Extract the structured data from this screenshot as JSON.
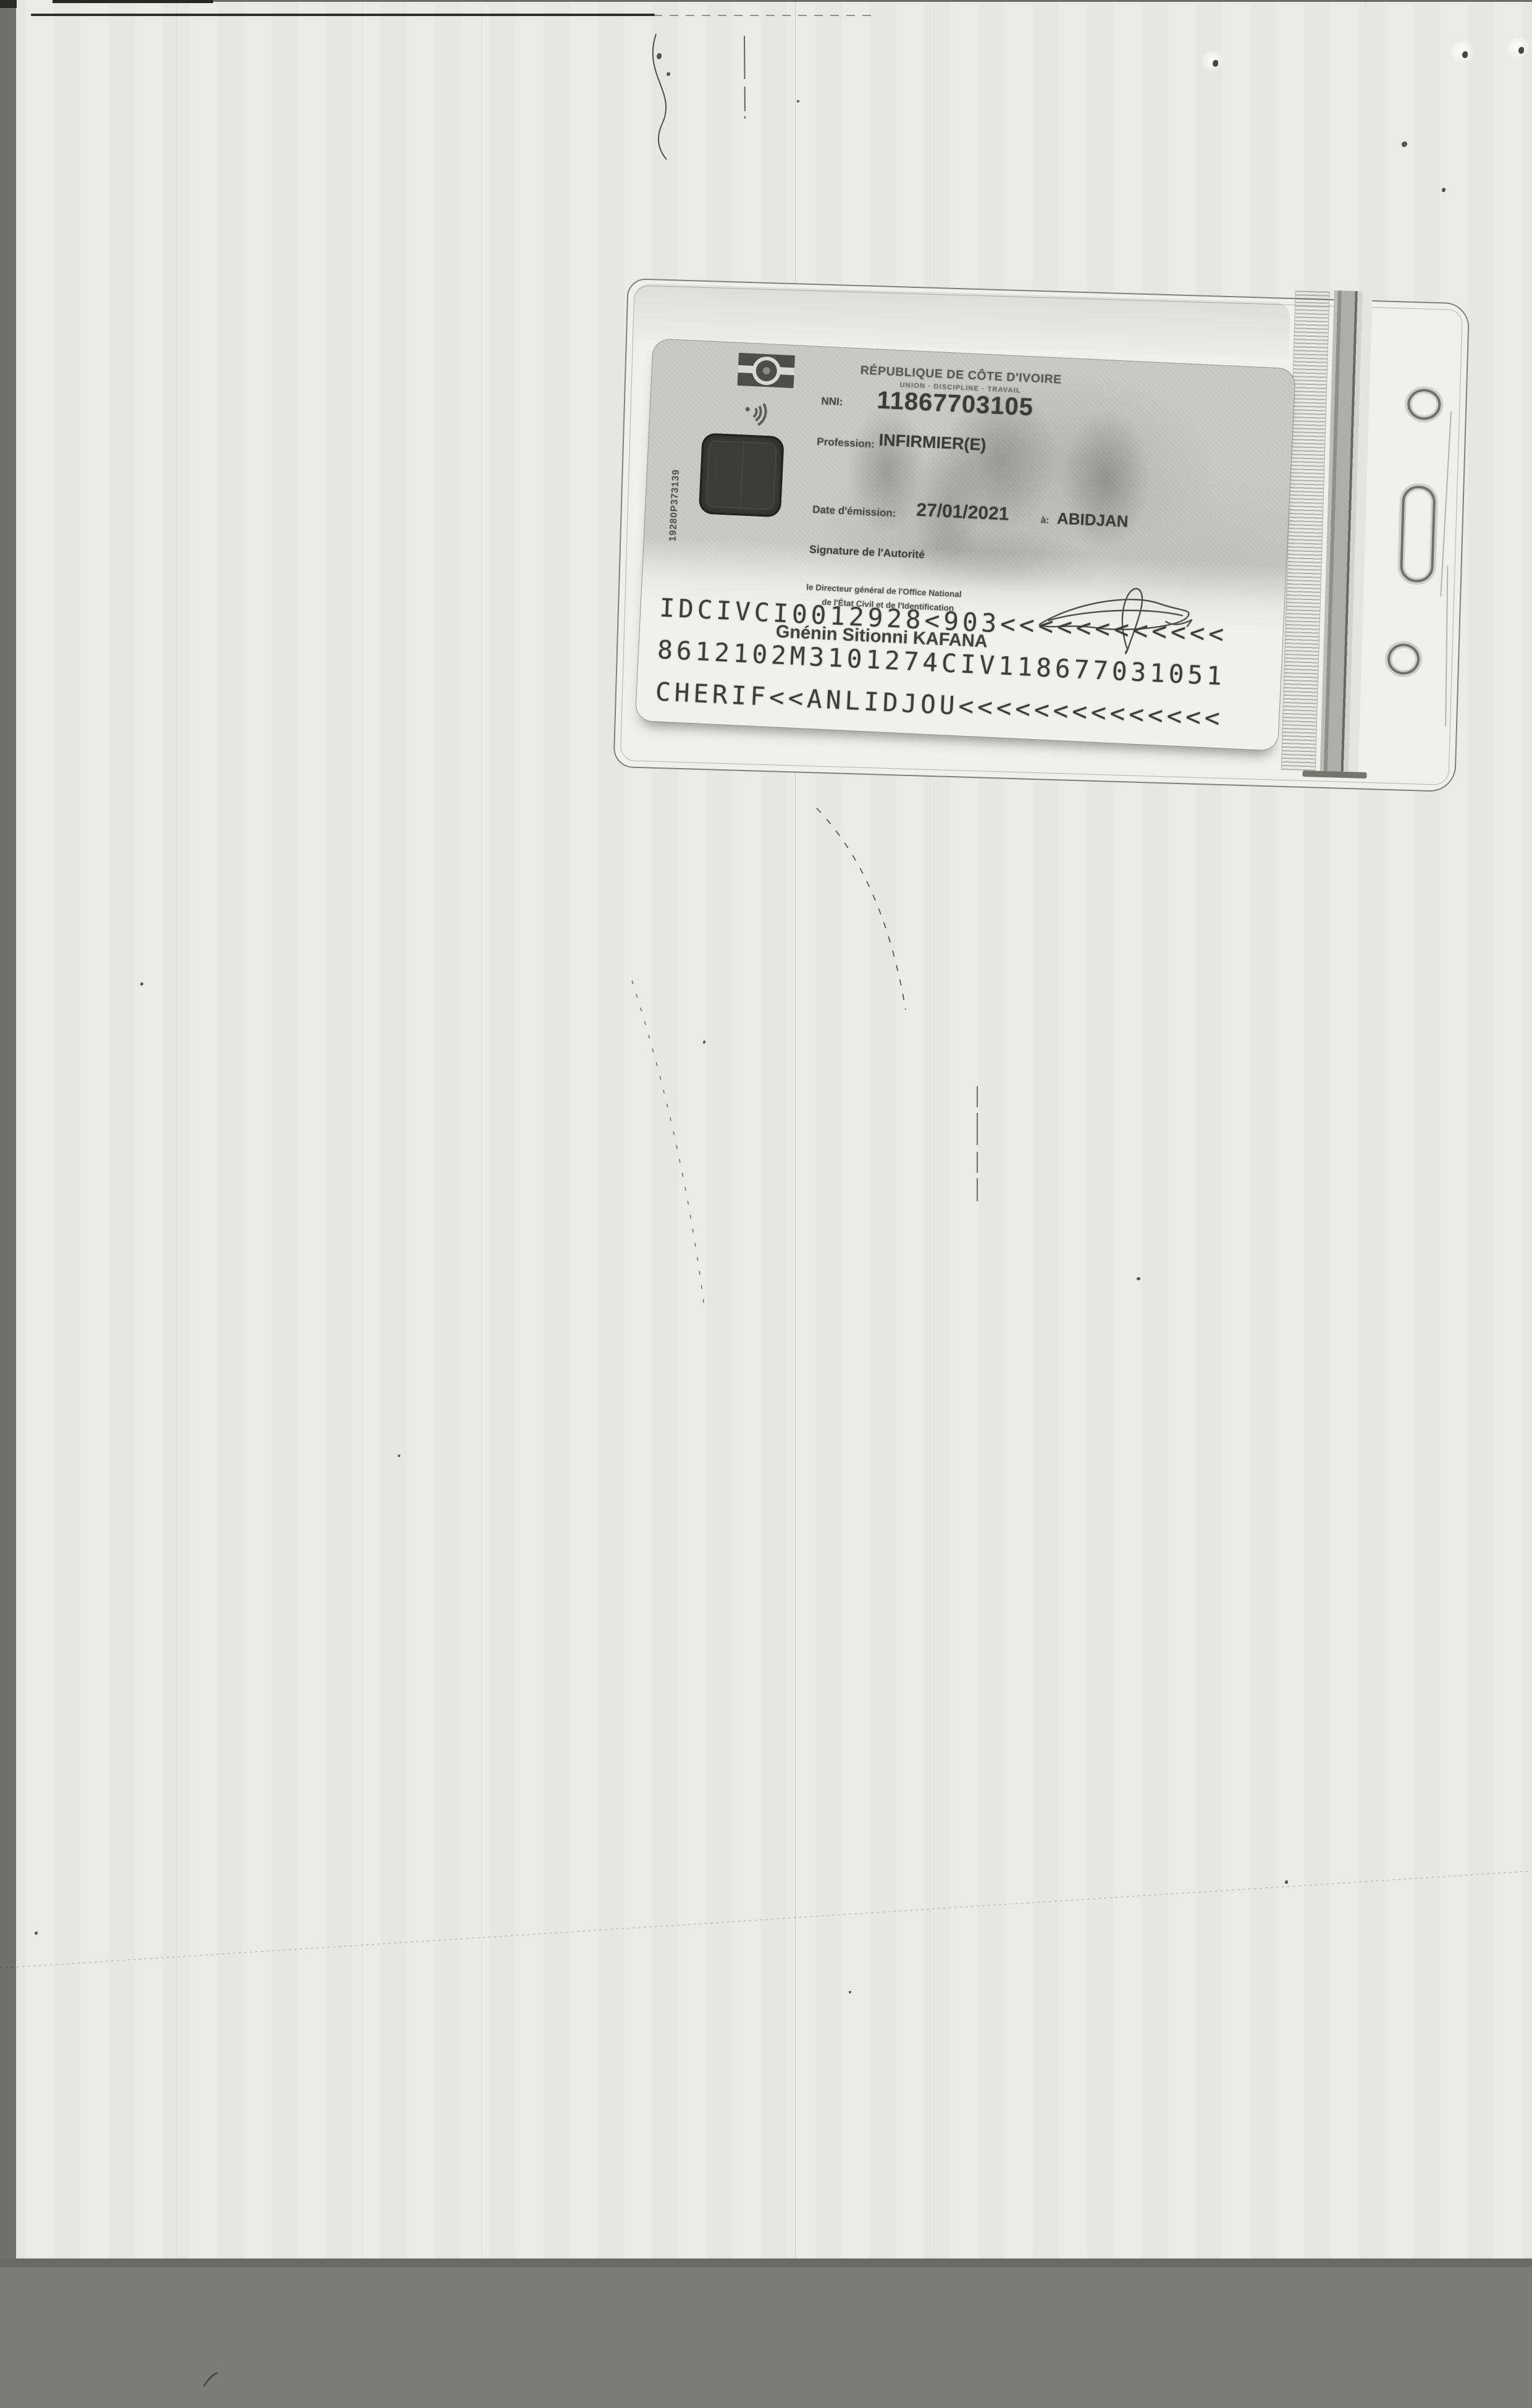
{
  "card": {
    "title": "RÉPUBLIQUE DE CÔTE D'IVOIRE",
    "motto": "UNION · DISCIPLINE · TRAVAIL",
    "fields": {
      "nni": {
        "label": "NNI:",
        "value": "11867703105"
      },
      "profession": {
        "label": "Profession:",
        "value": "INFIRMIER(E)"
      },
      "issue_date": {
        "label": "Date d'émission:",
        "value": "27/01/2021"
      },
      "issue_place": {
        "label": "à:",
        "value": "ABIDJAN"
      }
    },
    "signature_label": "Signature de l'Autorité",
    "authority_line1": "le Directeur général de l'Office National",
    "authority_line2": "de l'État Civil et de l'Identification",
    "authority_name": "Gnénin Sitionni KAFANA",
    "serial_vertical": "19280P373139",
    "mrz": {
      "line1": "IDCIVCI0012928<903<<<<<<<<<<<<",
      "line2": "8612102M3101274CIV118677031051",
      "line3": "CHERIF<<ANLIDJOU<<<<<<<<<<<<<<"
    },
    "icons": [
      "flag-logo",
      "contactless-icon",
      "smart-chip",
      "punch-hole"
    ]
  },
  "colors": {
    "paper": "#eaeae8",
    "scanner_bed": "#7b7b79",
    "card_base": "#c9c9c6",
    "mrz_background": "#f0f0ed",
    "ink": "#3f3f3d"
  }
}
